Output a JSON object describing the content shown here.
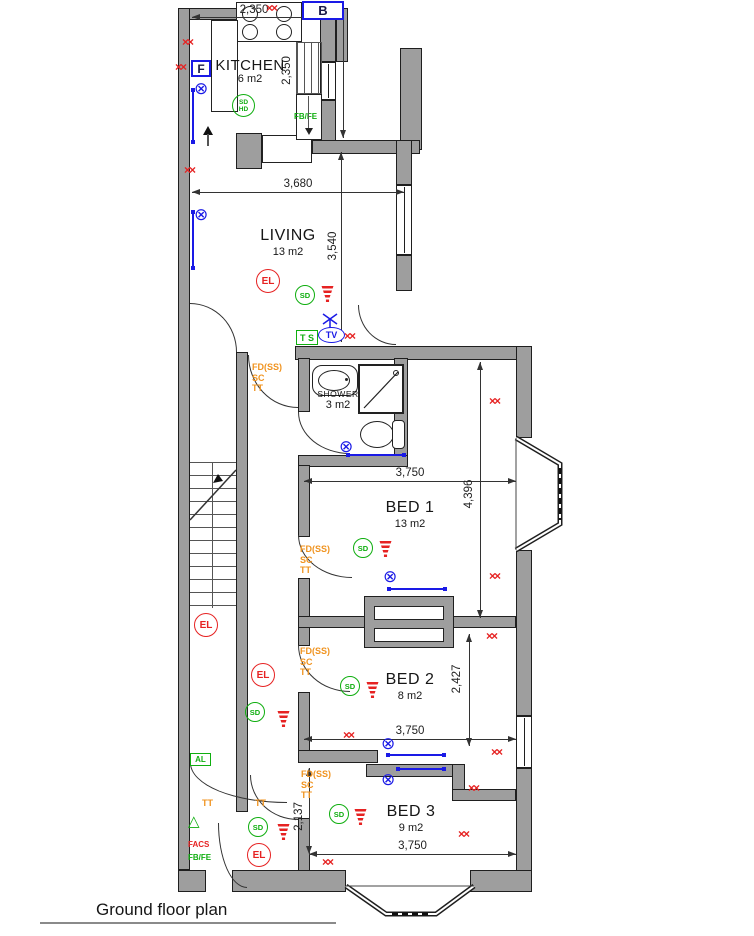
{
  "title": "Ground floor plan",
  "rooms": {
    "kitchen": {
      "name": "KITCHEN",
      "area": "6 m2"
    },
    "living": {
      "name": "LIVING",
      "area": "13 m2"
    },
    "shower": {
      "name": "SHOWER",
      "area": "3 m2"
    },
    "bed1": {
      "name": "BED 1",
      "area": "13 m2"
    },
    "bed2": {
      "name": "BED 2",
      "area": "8 m2"
    },
    "bed3": {
      "name": "BED 3",
      "area": "9 m2"
    }
  },
  "dims": {
    "kitchen_width": "2,350",
    "kitchen_stairs": "2,350",
    "living_width": "3,680",
    "living_height": "3,540",
    "bed1_width": "3,750",
    "bed1_height": "4,396",
    "bed2_width": "3,750",
    "bed2_height": "2,427",
    "bed3_width": "3,750",
    "bed3_height": "2,137"
  },
  "labels": {
    "boiler": "B",
    "fridge": "F",
    "thermostat": "T S",
    "tv": "TV",
    "smoke_detector": "SD",
    "heat_detector": "HD",
    "emergency_light": "EL",
    "fire_door": "FD(SS)",
    "self_closer": "SC",
    "tt": "TT",
    "alarm": "AL",
    "facs": "FACS",
    "fb_fe": "FB/FE"
  },
  "glyphs": {
    "ceiling_light": "⊗",
    "double_socket": "××",
    "escape_sign": "△"
  },
  "colors": {
    "wall_grey": "#9e9e9e",
    "safety_green": "#0fae0f",
    "alert_red": "#e62222",
    "electrical_blue": "#1a1ae6",
    "door_spec_orange": "#f0931f"
  }
}
